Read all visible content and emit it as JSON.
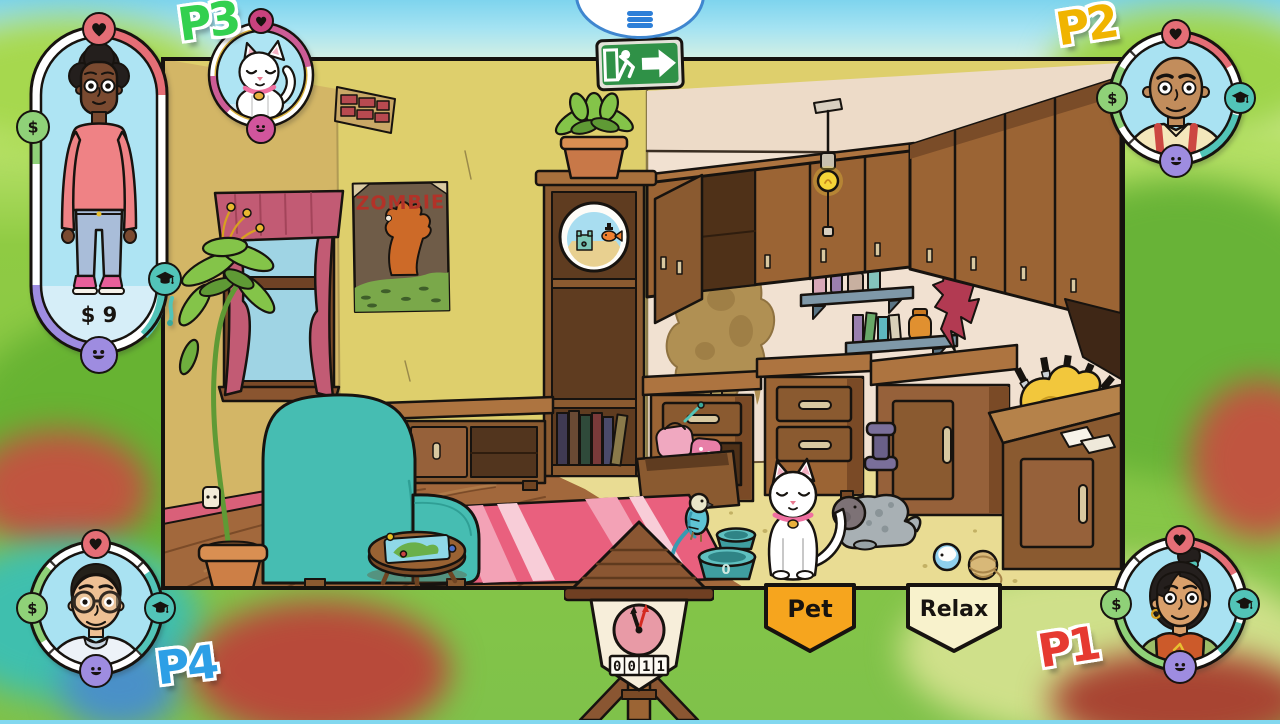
{
  "menu": {
    "icon": "hamburger-menu-icon"
  },
  "exit_sign": {
    "icon": "emergency-exit-running-man-icon",
    "color": "#2f9147"
  },
  "icons": {
    "money_glyph": "$"
  },
  "players": [
    {
      "id": "P1",
      "label": "P1",
      "label_color": "#e63a31",
      "position": "bottom-right",
      "portrait": "woman-with-bun-green-cardigan",
      "status_icons": [
        "heart-icon",
        "money-icon",
        "education-icon",
        "mood-icon"
      ]
    },
    {
      "id": "P2",
      "label": "P2",
      "label_color": "#f0b400",
      "position": "top-right",
      "portrait": "bald-man-with-suspenders",
      "status_icons": [
        "heart-icon",
        "money-icon",
        "education-icon",
        "mood-icon"
      ]
    },
    {
      "id": "P3",
      "label": "P3",
      "label_color": "#33d04f",
      "position": "top-left",
      "portrait": "woman-pink-sweater-full-body",
      "money": "$ 9",
      "status_icons": [
        "heart-icon",
        "money-icon",
        "education-icon",
        "mood-icon"
      ]
    },
    {
      "id": "P4",
      "label": "P4",
      "label_color": "#2d9fe6",
      "position": "bottom-left",
      "portrait": "man-with-glasses-white-tee",
      "status_icons": [
        "heart-icon",
        "money-icon",
        "education-icon",
        "mood-icon"
      ]
    }
  ],
  "pet_portrait": {
    "subject": "white-cat",
    "status_icons": [
      "heart-icon",
      "mood-icon"
    ]
  },
  "action_banners": [
    {
      "label": "Pet",
      "color": "#f6a51e"
    },
    {
      "label": "Relax",
      "color": "#f8f2cc"
    }
  ],
  "clock": {
    "counter": "0011",
    "digits": [
      "0",
      "0",
      "1",
      "1"
    ]
  },
  "scene": {
    "poster_title": "ZOMBIE",
    "bowl_mark": "0",
    "objects": [
      "window-with-curtains",
      "zombie-poster",
      "potted-plant",
      "teal-armchair",
      "tv-stand",
      "pink-striped-rug",
      "coffee-table-with-board-game",
      "bookshelf",
      "fishbowl",
      "shelf-plant",
      "upper-cabinets",
      "hanging-bulb",
      "wall-stain",
      "spice-shelves",
      "hanging-red-cloth",
      "drawer-chest-open",
      "drawer-chest",
      "kitchen-cabinet",
      "kitchen-counter",
      "rubber-chicken-with-knives",
      "napkins",
      "dumbbell",
      "pet-bowls",
      "parakeet",
      "white-cat",
      "seal-plush-toy",
      "toy-ball",
      "yarn-ball",
      "wall-socket",
      "cuckoo-clock"
    ]
  }
}
